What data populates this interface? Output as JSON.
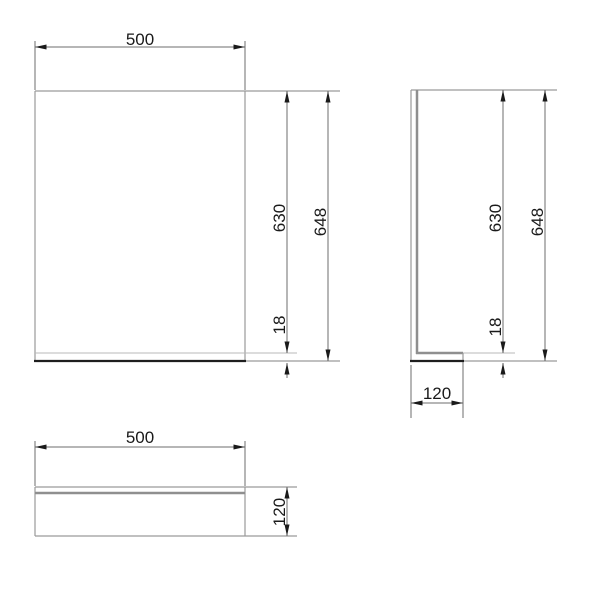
{
  "drawing": {
    "type": "technical-orthographic-drawing",
    "views": {
      "front": {
        "width_label": "500",
        "inner_height_label": "630",
        "total_height_label": "648",
        "bottom_thickness_label": "18"
      },
      "side": {
        "inner_height_label": "630",
        "total_height_label": "648",
        "bottom_thickness_label": "18",
        "depth_label": "120"
      },
      "bottom": {
        "width_label": "500",
        "depth_label": "120"
      }
    }
  },
  "colors": {
    "background": "#ffffff",
    "outline": "#9a9a9a",
    "outline_light": "#b8b8b8",
    "outline_thick": "#8f8f8f",
    "outline_black": "#1e1e1e",
    "dimension": "#6e6e6e",
    "text": "#1a1a1a"
  }
}
